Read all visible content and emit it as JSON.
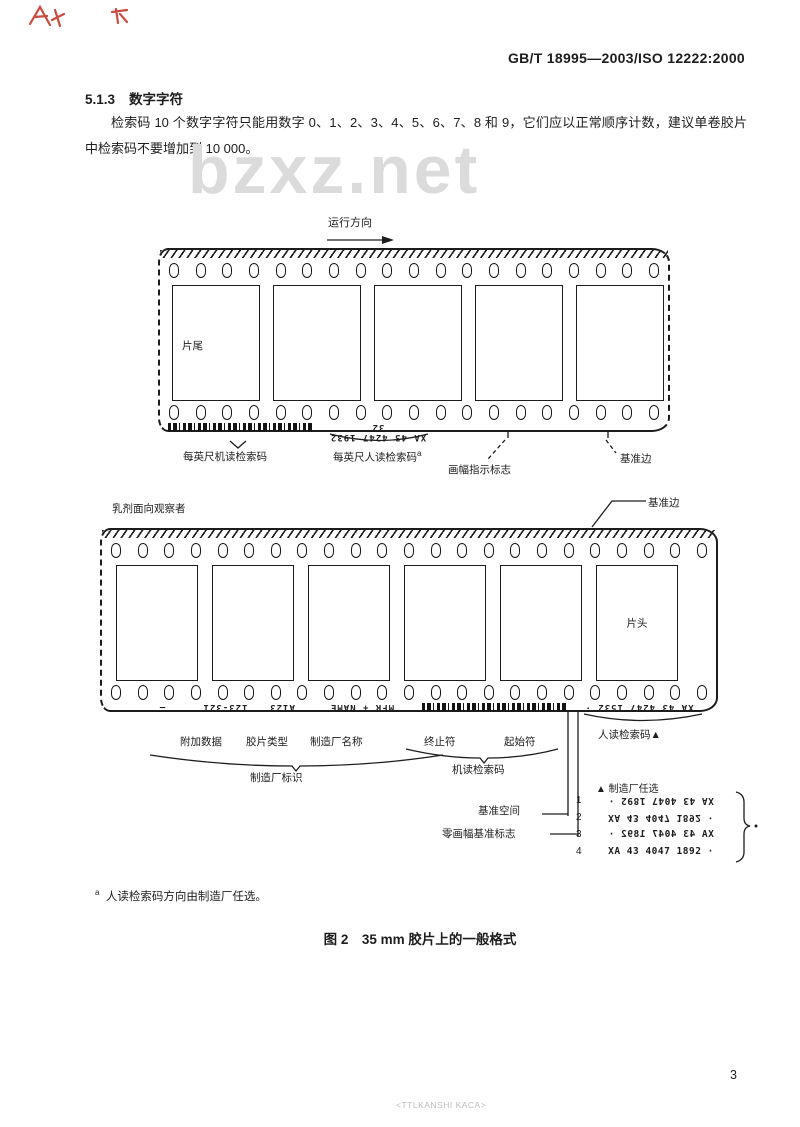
{
  "page": {
    "header": "GB/T 18995—2003/ISO 12222:2000",
    "section_number": "5.1.3",
    "section_title": "数字字符",
    "paragraph": "检索码 10 个数字字符只能用数字 0、1、2、3、4、5、6、7、8 和 9，它们应以正常顺序计数，建议单卷胶片中检索码不要增加到 10 000。",
    "watermark": "bzxz.net",
    "footnote_marker": "a",
    "footnote_text": "人读检索码方向由制造厂任选。",
    "figure_caption": "图 2　35 mm 胶片上的一般格式",
    "page_number": "3",
    "bottom_stamp": "<TTLKANSHI KACA>"
  },
  "diagram": {
    "direction_label": "运行方向",
    "strip1": {
      "holes_per_row": 19,
      "frame_label": "片尾",
      "edge_code": "XA 43 4247 1932  32",
      "label_machine_code": "每英尺机读检索码",
      "label_human_code": "每英尺人读检索码",
      "label_human_code_sup": "a",
      "label_frame_mark": "画幅指示标志",
      "label_reference_edge": "基准边"
    },
    "strip2": {
      "holes_per_row": 23,
      "emulsion_label": "乳剂面向观察者",
      "top_edge_label": "基准边",
      "frame_label": "片头",
      "edge_dash": "—",
      "edge_additional": "123-321",
      "edge_type": "A123",
      "edge_mfr": "MFR + NAME",
      "edge_code": "XA 43 4247 1532 ·",
      "label_additional": "附加数据",
      "label_type": "胶片类型",
      "label_mfr": "制造厂名称",
      "label_stop": "终止符",
      "label_start": "起始符",
      "label_mfr_id": "制造厂标识",
      "label_machine_code": "机读检索码",
      "label_human_code": "人读检索码▲",
      "label_ref_space": "基准空间",
      "label_zero_frame": "零画幅基准标志",
      "options_header": "▲ 制造厂任选",
      "options_code": "XA 43 4047 1892 ·",
      "options_numbers": [
        "1",
        "2",
        "3",
        "4"
      ]
    }
  },
  "colors": {
    "ink": "#1d1d1d",
    "watermark_gray": "#dbdbdb",
    "stamp_gray": "#bcbcbc",
    "red_mark": "#c4372e"
  }
}
